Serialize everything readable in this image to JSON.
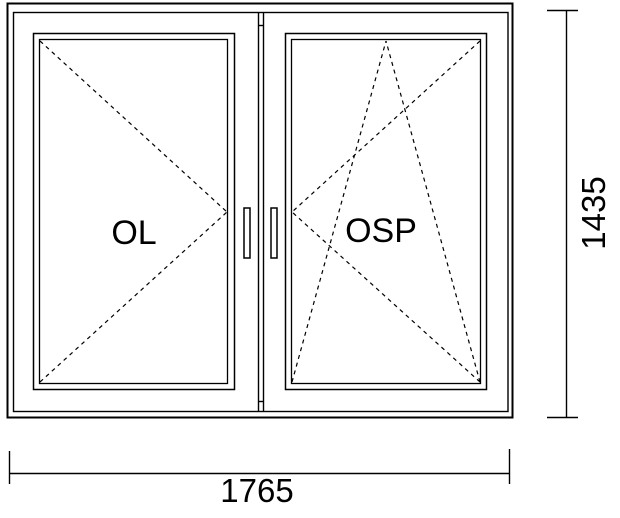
{
  "drawing": {
    "title": "window-elevation-drawing",
    "panels": [
      {
        "label": "OL",
        "opening_symbol": "turn-left-dashed-v"
      },
      {
        "label": "OSP",
        "opening_symbol": "tilt-turn-right-dashed"
      }
    ],
    "dimensions": {
      "width_label": "1765",
      "height_label": "1435"
    },
    "colors": {
      "line": "#000000",
      "background": "#ffffff"
    }
  }
}
